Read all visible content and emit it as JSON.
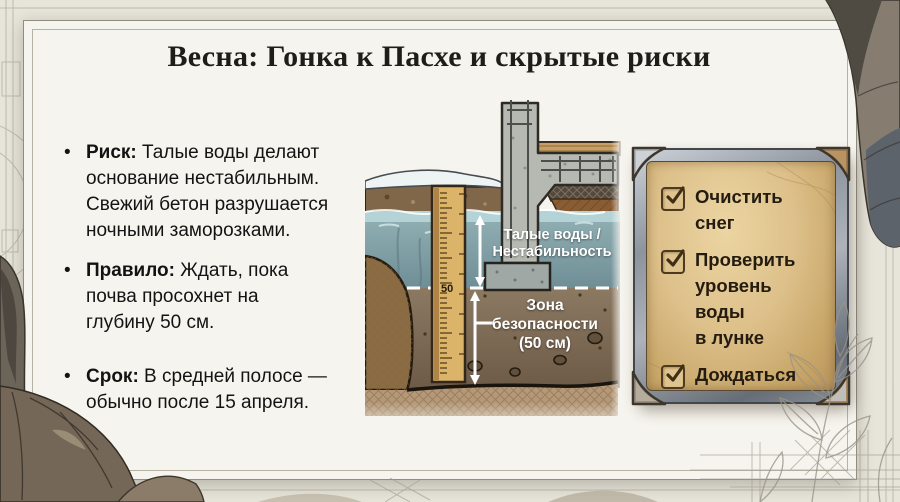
{
  "title": "Весна: Гонка к Пасхе и скрытые риски",
  "bullets": [
    {
      "label": "Риск:",
      "text": " Талые воды делают\nоснование нестабильным.\nСвежий бетон разрушается\nночными заморозками."
    },
    {
      "label": "Правило:",
      "text": " Ждать, пока\nпочва просохнет на\nглубину 50 см."
    },
    {
      "label": "Срок:",
      "text": " В средней полосе —\nобычно после 15 апреля."
    }
  ],
  "diagram": {
    "labels": {
      "water_zone_line1": "Талые воды /",
      "water_zone_line2": "Нестабильность",
      "safety_zone_line1": "Зона",
      "safety_zone_line2": "безопасности",
      "safety_zone_line3": "(50 см)",
      "ruler_mark": "50"
    }
  },
  "checklist": {
    "items": [
      {
        "label": "Очистить снег",
        "checked": true
      },
      {
        "label": "Проверить\nуровень воды\nв лунке",
        "checked": true
      },
      {
        "label": "Дождаться\nоткрытия дорог\nадминистрацией",
        "checked": true
      }
    ]
  },
  "colors": {
    "paper": "#f6f4ee",
    "plaque_gold": "#ddc08a",
    "plaque_metal": "#8d949d",
    "water": "#7e9ba1",
    "soil": "#7a6753",
    "ruler_wood": "#dbb369",
    "snow": "#eef4f3",
    "ink": "#131313"
  }
}
